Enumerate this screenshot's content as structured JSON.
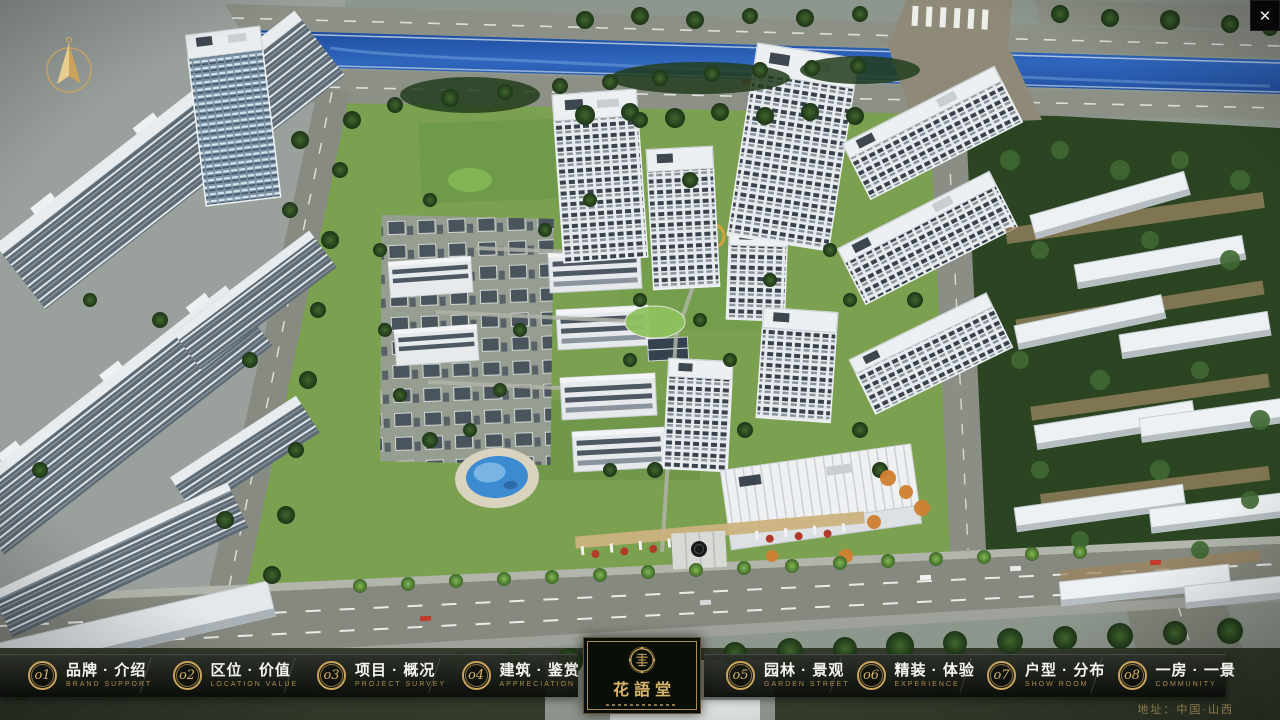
{
  "icons": {
    "close": "✕",
    "compass": "north-arrow",
    "logo_seal": "round-seal-emblem"
  },
  "nav": {
    "items": [
      {
        "num": "o1",
        "zh": "品牌 · 介绍",
        "en": "BRAND SUPPORT"
      },
      {
        "num": "o2",
        "zh": "区位 · 价值",
        "en": "LOCATION VALUE"
      },
      {
        "num": "o3",
        "zh": "项目 · 概况",
        "en": "PROJECT SURVEY"
      },
      {
        "num": "o4",
        "zh": "建筑 · 鉴赏",
        "en": "APPRECIATION"
      },
      {
        "num": "o5",
        "zh": "园林 · 景观",
        "en": "GARDEN STREET"
      },
      {
        "num": "o6",
        "zh": "精装 · 体验",
        "en": "EXPERIENCE"
      },
      {
        "num": "o7",
        "zh": "户型 · 分布",
        "en": "SHOW ROOM"
      },
      {
        "num": "o8",
        "zh": "一房 · 一景",
        "en": "COMMUNITY"
      }
    ]
  },
  "logo": {
    "title": "花語堂"
  },
  "footer": {
    "address": "地址：中国·山西"
  },
  "colors": {
    "gold_accent": "#c9a45e",
    "bar_background": "#0c0f0a",
    "river_blue": "#2a5cb0",
    "grass_green": "#7ba050",
    "tree_green": "#2c4a25",
    "building_white": "#e9edf0"
  }
}
